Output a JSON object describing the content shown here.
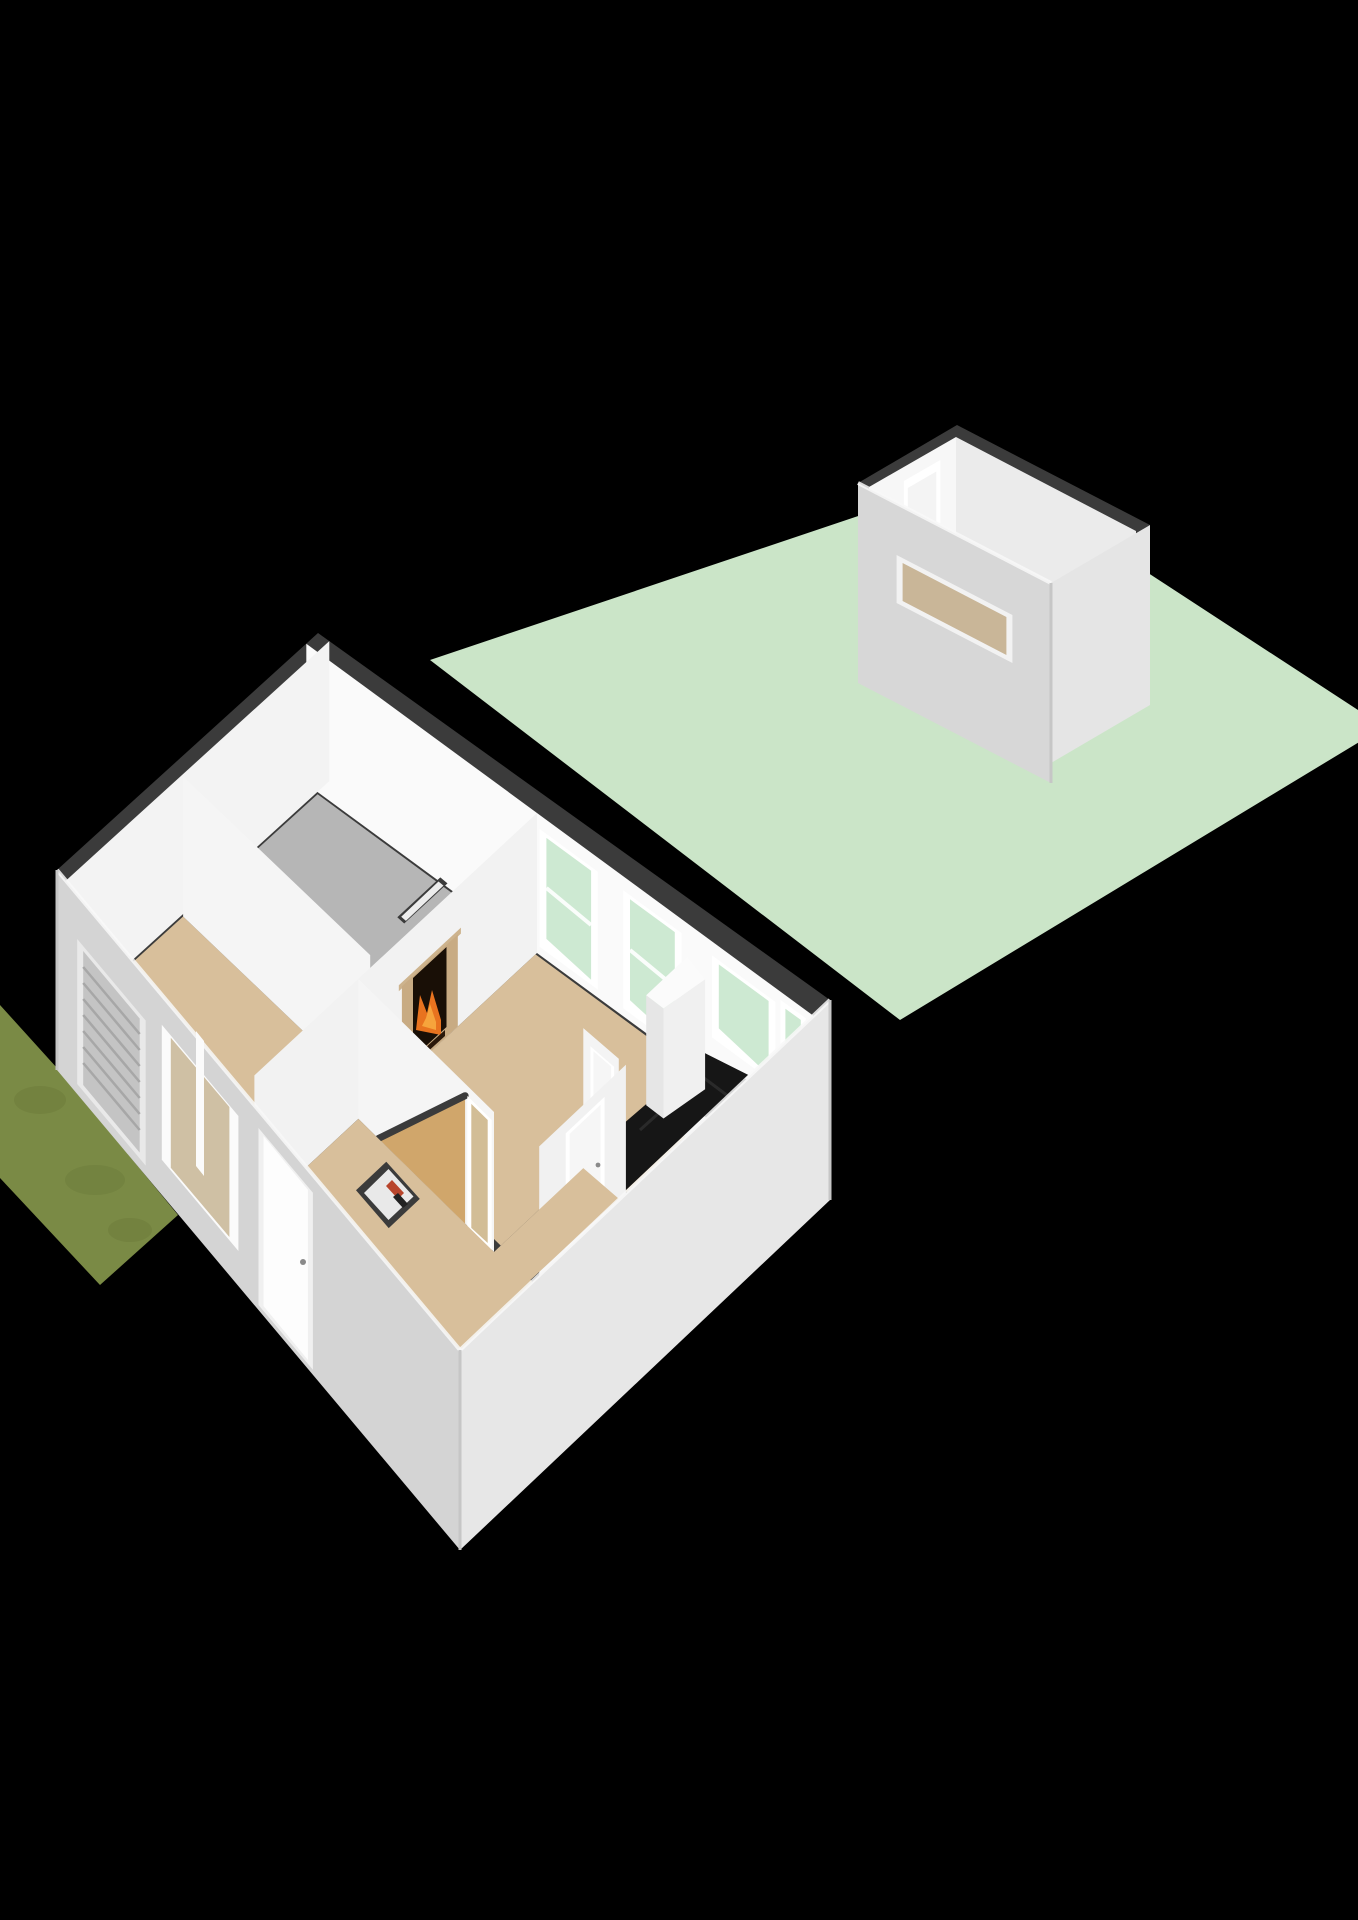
{
  "scene": {
    "kind": "3d-floorplan-isometric-render",
    "background": "#000000",
    "buildings": [
      "main-house-ground-floor",
      "garden-shed"
    ],
    "outdoor": [
      "back-garden",
      "front-grass-strip"
    ]
  },
  "palette": {
    "background": "#000000",
    "wall_top": "#3b3b3b",
    "garden": "#cbe5c8",
    "grass": "#7a8a45",
    "grass_dark": "#6b7a39",
    "wall_inner_bright": "#fafafa",
    "wall_inner": "#f5f5f5",
    "wall_inner_dim": "#f2f2f2",
    "wall_inner_soft": "#f3f3f3",
    "wall_face_a": "#f4f4f4",
    "wall_face_b": "#f1f1f1",
    "ext_sw": "#d4d4d4",
    "ext_se": "#e7e7e7",
    "floor_garage": "#b6b6b6",
    "floor_wood": "#d8bf9b",
    "floor_bath": "#b4c0cd",
    "floor_shed": "#c6ae8e",
    "stairs_wood": "#d0a66b",
    "glass_garden": "#cde9d2",
    "glass_front": "#cfc0a4",
    "glass_door_inner": "#d2bd96",
    "glass_shed": "#c9b698",
    "frame_white": "#ffffff",
    "frame_soft": "#fbfbfb",
    "blinds_panel": "#c4c4c4",
    "blinds_frame": "#e9e9e9",
    "counter_black": "#161616",
    "cabinet_white": "#fbfbfb",
    "mantel": "#c8ab83",
    "mantel_shelf": "#cdb38d",
    "firebox": "#190f06",
    "fire": "#e8731f",
    "fire_glow": "#f6a43c",
    "logs": "#2a180a",
    "meter_red": "#b8452c",
    "meter_dark": "#222222",
    "door_panel": "#f6f6f6",
    "appliance": "#fcfcfc",
    "appliance_side": "#f0f0f0",
    "appliance_shade": "#e9e9e9",
    "shed_ext_sw": "#d7d7d7",
    "shed_ext_se": "#e5e5e5",
    "shed_inner_nw": "#f7f7f7",
    "shed_inner_ne": "#ebebeb",
    "skirt_white": "#efefef",
    "cupboard_inner": "#e9e9e9"
  },
  "rooms": [
    {
      "id": "garage",
      "floor_color": "#b6b6b6"
    },
    {
      "id": "front-sitting-room",
      "floor_color": "#d8bf9b"
    },
    {
      "id": "living-room",
      "floor_color": "#d8bf9b"
    },
    {
      "id": "kitchen",
      "floor_color": "#d8bf9b"
    },
    {
      "id": "bathroom",
      "floor_color": "#b4c0cd"
    },
    {
      "id": "entrance-hall",
      "floor_color": "#d8bf9b"
    },
    {
      "id": "shed-interior",
      "floor_color": "#c6ae8e"
    }
  ],
  "features": [
    "fireplace-with-burning-fire",
    "chimney-niche",
    "kitchen-counter-black",
    "tall-kitchen-cabinet",
    "washing-machine",
    "staircase-diagonal",
    "meter-cupboard-with-red-boiler",
    "front-door",
    "garden-glass-door",
    "roller-blinds-window",
    "front-window",
    "garden-windows",
    "shed-door",
    "shed-slit-window"
  ]
}
